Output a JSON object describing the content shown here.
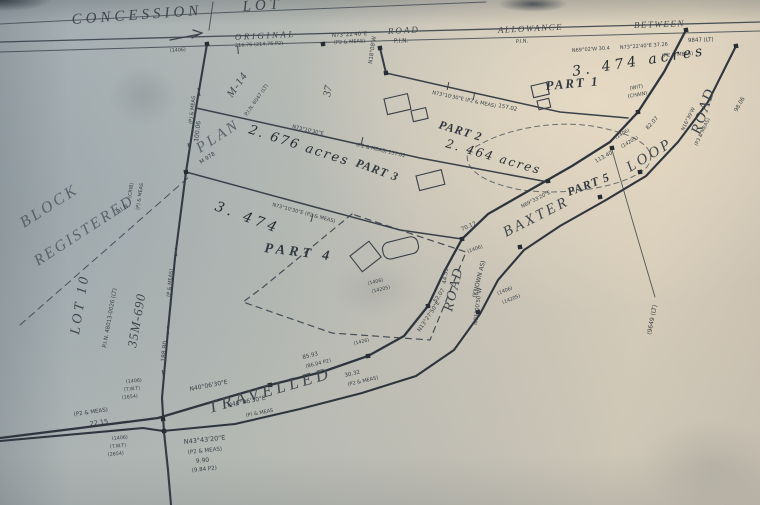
{
  "photo": {
    "paper_tint_left": "#a6b0b5",
    "paper_tint_right": "#d6ccb9",
    "ink_color": "#3a4147"
  },
  "plan": {
    "parts": [
      {
        "name": "PART 1",
        "acreage": "3.474 acres"
      },
      {
        "name": "PART 2",
        "acreage": "2.464 acres"
      },
      {
        "name": "PART 3",
        "acreage": "2.676 acres"
      },
      {
        "name": "PART 4",
        "acreage": "3.474"
      },
      {
        "name": "PART 5",
        "acreage": ""
      }
    ],
    "roads": [
      "ORIGINAL ROAD ALLOWANCE BETWEEN",
      "BAXTER LOOP ROAD",
      "TRAVELLED ROAD (KNOWN AS)"
    ],
    "annotations": [
      {
        "id": "concession",
        "text": "CONCESSION",
        "x": 72,
        "y": 24,
        "r": -4,
        "s": 15,
        "ls": 4,
        "k": "print"
      },
      {
        "id": "lot",
        "text": "LOT",
        "x": 243,
        "y": 11,
        "r": -4,
        "s": 15,
        "ls": 4,
        "k": "print"
      },
      {
        "id": "original",
        "text": "ORIGINAL",
        "x": 235,
        "y": 40,
        "r": -3,
        "s": 9,
        "ls": 2.5,
        "k": "print"
      },
      {
        "id": "road-allowance",
        "text": "ROAD",
        "x": 388,
        "y": 34,
        "r": -3,
        "s": 9,
        "ls": 2,
        "k": "print"
      },
      {
        "id": "pin-road",
        "text": "P.I.N.",
        "x": 394,
        "y": 43,
        "r": -3,
        "s": 6,
        "k": "tiny"
      },
      {
        "id": "allowance",
        "text": "ALLOWANCE",
        "x": 498,
        "y": 33,
        "r": -3,
        "s": 9,
        "ls": 1.5,
        "k": "print"
      },
      {
        "id": "pin-allowance",
        "text": "P.I.N.",
        "x": 516,
        "y": 43,
        "r": -3,
        "s": 5,
        "k": "tiny"
      },
      {
        "id": "between",
        "text": "BETWEEN",
        "x": 634,
        "y": 28,
        "r": -2,
        "s": 9,
        "ls": 1.5,
        "k": "print"
      },
      {
        "id": "lt-between",
        "text": "9847 (LT)",
        "x": 688,
        "y": 42,
        "r": -2,
        "s": 5.5,
        "k": "tiny"
      },
      {
        "id": "part-1",
        "text": "PART 1",
        "x": 546,
        "y": 90,
        "r": -5,
        "s": 13,
        "ls": 2,
        "k": "bold"
      },
      {
        "id": "part-2",
        "text": "PART 2",
        "x": 438,
        "y": 128,
        "r": 17,
        "s": 12,
        "ls": 1,
        "k": "bold"
      },
      {
        "id": "part-3",
        "text": "PART 3",
        "x": 355,
        "y": 166,
        "r": 20,
        "s": 12,
        "ls": 1,
        "k": "bold"
      },
      {
        "id": "part-4",
        "text": "PART 4",
        "x": 264,
        "y": 252,
        "r": 7,
        "s": 14,
        "ls": 4,
        "k": "bold"
      },
      {
        "id": "part-5",
        "text": "PART 5",
        "x": 569,
        "y": 196,
        "r": -21,
        "s": 12,
        "ls": 1,
        "k": "bold"
      },
      {
        "id": "baxter",
        "text": "BAXTER",
        "x": 506,
        "y": 237,
        "r": -27,
        "s": 15,
        "ls": 3,
        "k": "print"
      },
      {
        "id": "loop",
        "text": "LOOP",
        "x": 630,
        "y": 172,
        "r": -31,
        "s": 15,
        "ls": 3,
        "k": "print"
      },
      {
        "id": "road-right",
        "text": "ROAD",
        "x": 700,
        "y": 135,
        "r": -72,
        "s": 15,
        "ls": 2,
        "k": "print"
      },
      {
        "id": "travelled",
        "text": "TRAVELLED",
        "x": 210,
        "y": 413,
        "r": -16,
        "s": 17,
        "ls": 4,
        "k": "print"
      },
      {
        "id": "road-bend",
        "text": "ROAD",
        "x": 452,
        "y": 312,
        "r": -76,
        "s": 14,
        "ls": 2,
        "k": "print"
      },
      {
        "id": "known-as",
        "text": "(KNOWN AS)",
        "x": 476,
        "y": 298,
        "r": -76,
        "s": 6,
        "k": "tiny"
      },
      {
        "id": "block",
        "text": "BLOCK",
        "x": 24,
        "y": 228,
        "r": -33,
        "s": 16,
        "ls": 3,
        "k": "faded"
      },
      {
        "id": "registered",
        "text": "REGISTERED",
        "x": 38,
        "y": 266,
        "r": -33,
        "s": 15.5,
        "ls": 2.5,
        "k": "faded"
      },
      {
        "id": "pin-registered",
        "text": "P.I.N.",
        "x": 118,
        "y": 214,
        "r": -33,
        "s": 6,
        "k": "tiny"
      },
      {
        "id": "plan",
        "text": "PLAN",
        "x": 200,
        "y": 153,
        "r": -33,
        "s": 15,
        "ls": 3,
        "k": "faded"
      },
      {
        "id": "plan-m978",
        "text": "M 978",
        "x": 201,
        "y": 164,
        "r": -33,
        "s": 5.5,
        "k": "tiny"
      },
      {
        "id": "lot-10",
        "text": "LOT 10",
        "x": 79,
        "y": 335,
        "r": -81,
        "s": 14,
        "ls": 3,
        "k": "print"
      },
      {
        "id": "pin-lot10",
        "text": "P.I.N. 48013-0026 (LT)",
        "x": 106,
        "y": 348,
        "r": -80,
        "s": 5.5,
        "k": "tiny"
      },
      {
        "id": "plan-35m690",
        "text": "35M-690",
        "x": 136,
        "y": 348,
        "r": -80,
        "s": 13,
        "ls": 1,
        "k": "print"
      },
      {
        "id": "plan-m14",
        "text": "M-14",
        "x": 232,
        "y": 98,
        "r": -55,
        "s": 11,
        "ls": 1,
        "k": "print"
      },
      {
        "id": "pin-m14",
        "text": "P.I.N. 6047 (LT)",
        "x": 247,
        "y": 116,
        "r": -55,
        "s": 5,
        "k": "tiny"
      },
      {
        "id": "lot-37",
        "text": "37",
        "x": 330,
        "y": 97,
        "r": -80,
        "s": 11,
        "k": "print"
      },
      {
        "id": "hw-part1-acres",
        "text": "3. 474 acres",
        "x": 573,
        "y": 76,
        "r": -9,
        "s": 14,
        "ls": 4,
        "k": "hand"
      },
      {
        "id": "hw-part2-acres",
        "text": "2. 464 acres",
        "x": 445,
        "y": 147,
        "r": 16,
        "s": 12,
        "ls": 2,
        "k": "hand"
      },
      {
        "id": "hw-part3-acres",
        "text": "2. 676 acres",
        "x": 248,
        "y": 133,
        "r": 18,
        "s": 13,
        "ls": 2,
        "k": "hand"
      },
      {
        "id": "hw-part4-area",
        "text": "3. 474",
        "x": 214,
        "y": 210,
        "r": 20,
        "s": 14,
        "ls": 4,
        "k": "hand"
      },
      {
        "text": "N73°22'40\"E",
        "x": 332,
        "y": 37,
        "r": -3,
        "s": 5.5
      },
      {
        "text": "(P2 & MEAS)",
        "x": 334,
        "y": 44,
        "r": -3,
        "s": 5
      },
      {
        "text": "216.76 (214.76 P2)",
        "x": 235,
        "y": 47,
        "r": -3,
        "s": 5
      },
      {
        "text": "N73°22'40\"E  37.26",
        "x": 620,
        "y": 49,
        "r": -4,
        "s": 5
      },
      {
        "text": "(P2 & MEAS)",
        "x": 662,
        "y": 57,
        "r": -4,
        "s": 5
      },
      {
        "text": "N69°02'W 30.4",
        "x": 572,
        "y": 52,
        "r": -4,
        "s": 5
      },
      {
        "text": "(WIT)",
        "x": 630,
        "y": 90,
        "r": -10,
        "s": 5
      },
      {
        "text": "(CHAIN)",
        "x": 628,
        "y": 98,
        "r": -10,
        "s": 5
      },
      {
        "text": "N18°08'W",
        "x": 372,
        "y": 64,
        "r": -82,
        "s": 5.5
      },
      {
        "text": "(P) & MEAS",
        "x": 192,
        "y": 124,
        "r": -83,
        "s": 5
      },
      {
        "text": "100.06",
        "x": 198,
        "y": 142,
        "r": -83,
        "s": 6
      },
      {
        "text": "(P & MEAS)",
        "x": 170,
        "y": 297,
        "r": -84,
        "s": 5
      },
      {
        "text": "188.80",
        "x": 165,
        "y": 362,
        "r": -84,
        "s": 6
      },
      {
        "text": "N73°10'30\"E (P2 & MEAS)",
        "x": 432,
        "y": 94,
        "r": 12,
        "s": 5
      },
      {
        "text": "157.02",
        "x": 498,
        "y": 107,
        "r": 12,
        "s": 5.5
      },
      {
        "text": "N73°10'30\"E",
        "x": 292,
        "y": 128,
        "r": 13,
        "s": 5
      },
      {
        "text": "(P2 & MEAS) 157.02",
        "x": 356,
        "y": 146,
        "r": 13,
        "s": 5
      },
      {
        "text": "N73°10'30\"E (P2 & MEAS)",
        "x": 272,
        "y": 206,
        "r": 15,
        "s": 5
      },
      {
        "text": "N69°33'20\"E",
        "x": 522,
        "y": 208,
        "r": -27,
        "s": 5
      },
      {
        "text": "113.40",
        "x": 596,
        "y": 163,
        "r": -29,
        "s": 5.5
      },
      {
        "text": "82.07",
        "x": 648,
        "y": 130,
        "r": -48,
        "s": 5.5
      },
      {
        "text": "N16°39'W",
        "x": 684,
        "y": 131,
        "r": -64,
        "s": 5
      },
      {
        "text": "(P3 & MEAS)",
        "x": 697,
        "y": 146,
        "r": -64,
        "s": 4.8
      },
      {
        "text": "98.06",
        "x": 737,
        "y": 112,
        "r": -60,
        "s": 5.5
      },
      {
        "text": "N01°00'50\"W",
        "x": 477,
        "y": 325,
        "r": -83,
        "s": 5.5
      },
      {
        "text": "44.51",
        "x": 446,
        "y": 284,
        "r": -83,
        "s": 5.5
      },
      {
        "text": "70.17",
        "x": 462,
        "y": 231,
        "r": -24,
        "s": 5.5
      },
      {
        "text": "N13°27'50\"E",
        "x": 420,
        "y": 332,
        "r": -56,
        "s": 5.5
      },
      {
        "text": "52.07",
        "x": 436,
        "y": 303,
        "r": -56,
        "s": 5.5
      },
      {
        "text": "(1406)",
        "x": 498,
        "y": 295,
        "r": -22,
        "s": 4.8
      },
      {
        "text": "(14205)",
        "x": 503,
        "y": 304,
        "r": -22,
        "s": 4.8
      },
      {
        "text": "(1406)",
        "x": 368,
        "y": 285,
        "r": -14,
        "s": 4.8
      },
      {
        "text": "(14205)",
        "x": 372,
        "y": 293,
        "r": -14,
        "s": 4.8
      },
      {
        "text": "85.93",
        "x": 303,
        "y": 359,
        "r": -14,
        "s": 5.5
      },
      {
        "text": "(86.04 P2)",
        "x": 306,
        "y": 368,
        "r": -14,
        "s": 5
      },
      {
        "text": "30.32",
        "x": 345,
        "y": 377,
        "r": -13,
        "s": 5.5
      },
      {
        "text": "(P2 & MEAS)",
        "x": 348,
        "y": 386,
        "r": -13,
        "s": 5
      },
      {
        "text": "N40°06'30\"E",
        "x": 190,
        "y": 391,
        "r": -11,
        "s": 6
      },
      {
        "text": "N40°06'30\"E",
        "x": 228,
        "y": 407,
        "r": -11,
        "s": 6
      },
      {
        "text": "(P) & MEAS",
        "x": 246,
        "y": 417,
        "r": -11,
        "s": 5
      },
      {
        "text": "(P2 & MEAS)",
        "x": 74,
        "y": 416,
        "r": -8,
        "s": 5.5
      },
      {
        "text": "22.15",
        "x": 90,
        "y": 426,
        "r": -8,
        "s": 6.5
      },
      {
        "text": "(1406)",
        "x": 126,
        "y": 383,
        "r": -5,
        "s": 4.8
      },
      {
        "text": "(T.W.T)",
        "x": 124,
        "y": 391,
        "r": -5,
        "s": 4.8
      },
      {
        "text": "(1654)",
        "x": 122,
        "y": 399,
        "r": -5,
        "s": 4.8
      },
      {
        "text": "(1406)",
        "x": 112,
        "y": 440,
        "r": -5,
        "s": 4.8
      },
      {
        "text": "(T.W.T)",
        "x": 110,
        "y": 448,
        "r": -5,
        "s": 4.8
      },
      {
        "text": "(2654)",
        "x": 108,
        "y": 456,
        "r": -5,
        "s": 4.8
      },
      {
        "text": "N43°43'20\"E",
        "x": 184,
        "y": 444,
        "r": -6,
        "s": 6.5
      },
      {
        "text": "(P2 & MEAS)",
        "x": 188,
        "y": 454,
        "r": -6,
        "s": 5.5
      },
      {
        "text": "9.90",
        "x": 196,
        "y": 463,
        "r": -6,
        "s": 6
      },
      {
        "text": "(9.84 P2)",
        "x": 192,
        "y": 472,
        "r": -6,
        "s": 5.5
      },
      {
        "text": "(1426)",
        "x": 354,
        "y": 345,
        "r": -14,
        "s": 4.8
      },
      {
        "text": "(9649 (LT)",
        "x": 651,
        "y": 335,
        "r": -79,
        "s": 6
      },
      {
        "text": "(1406)",
        "x": 616,
        "y": 139,
        "r": -30,
        "s": 4.8
      },
      {
        "text": "(14205)",
        "x": 622,
        "y": 148,
        "r": -30,
        "s": 4.8
      },
      {
        "text": "(CRIB)",
        "x": 131,
        "y": 198,
        "r": -81,
        "s": 4.8
      },
      {
        "text": "(P) & MEAS",
        "x": 139,
        "y": 210,
        "r": -81,
        "s": 4.8
      },
      {
        "text": "(1406)",
        "x": 170,
        "y": 52,
        "r": -4,
        "s": 4.8
      },
      {
        "text": "(1406)",
        "x": 468,
        "y": 253,
        "r": -20,
        "s": 4.8
      }
    ],
    "structures": [
      {
        "x": 384,
        "y": 99,
        "w": 24,
        "h": 16,
        "r": -13
      },
      {
        "x": 411,
        "y": 111,
        "w": 15,
        "h": 11,
        "r": -13
      },
      {
        "x": 531,
        "y": 86,
        "w": 16,
        "h": 12,
        "r": -13
      },
      {
        "x": 537,
        "y": 101,
        "w": 12,
        "h": 9,
        "r": -13
      },
      {
        "x": 416,
        "y": 176,
        "w": 26,
        "h": 15,
        "r": -14
      },
      {
        "x": 350,
        "y": 256,
        "w": 24,
        "h": 20,
        "r": -38
      },
      {
        "x": 381,
        "y": 244,
        "w": 36,
        "h": 17,
        "r": -14,
        "rx": 7
      }
    ],
    "monuments": [
      [
        207,
        44
      ],
      [
        323,
        44
      ],
      [
        380,
        48
      ],
      [
        386,
        73
      ],
      [
        186,
        172
      ],
      [
        548,
        181
      ],
      [
        462,
        239
      ],
      [
        428,
        306
      ],
      [
        368,
        356
      ],
      [
        270,
        385
      ],
      [
        163,
        419
      ],
      [
        164,
        431
      ],
      [
        612,
        148
      ],
      [
        638,
        112
      ],
      [
        640,
        172
      ],
      [
        520,
        247
      ],
      [
        478,
        312
      ],
      [
        686,
        30
      ],
      [
        736,
        46
      ],
      [
        600,
        197
      ]
    ],
    "ticks": [
      [
        199,
        92,
        75
      ],
      [
        189,
        147,
        75
      ],
      [
        176,
        252,
        78
      ],
      [
        168,
        330,
        80
      ],
      [
        163,
        374,
        80
      ],
      [
        448,
        86,
        -78
      ],
      [
        362,
        141,
        -77
      ],
      [
        312,
        218,
        -74
      ],
      [
        238,
        50,
        85
      ],
      [
        474,
        96,
        -78
      ]
    ]
  }
}
